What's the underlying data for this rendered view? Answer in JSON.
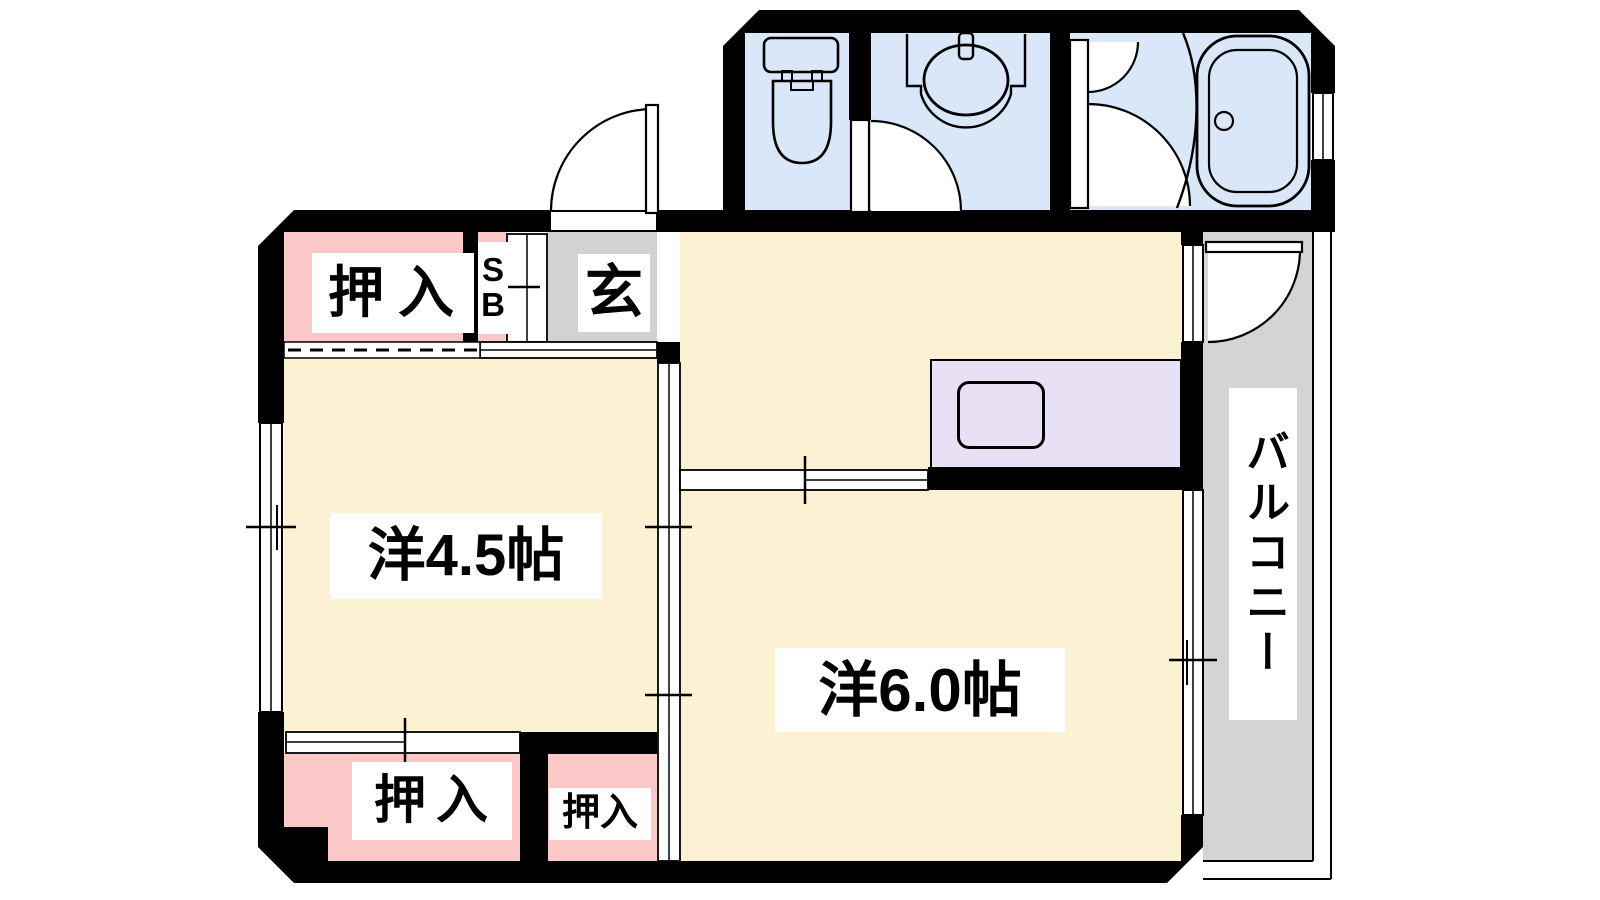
{
  "plan": {
    "type": "apartment-floor-plan",
    "labels": {
      "closet_top": "押入",
      "shoe_box": "SB",
      "entrance": "玄",
      "room_45": "洋4.5帖",
      "room_60": "洋6.0帖",
      "balcony": "バルコニー",
      "closet_bottom_large": "押入",
      "closet_bottom_small": "押入"
    },
    "colors": {
      "wall": "#000000",
      "room_floor": "#FCF1D2",
      "closet_floor": "#FBC7C7",
      "wet_area_floor": "#D9E7F9",
      "kitchen_counter": "#E8E0F4",
      "entrance_floor": "#D2D2D2",
      "balcony_floor": "#D4D4D4",
      "background": "#FFFFFF"
    }
  }
}
